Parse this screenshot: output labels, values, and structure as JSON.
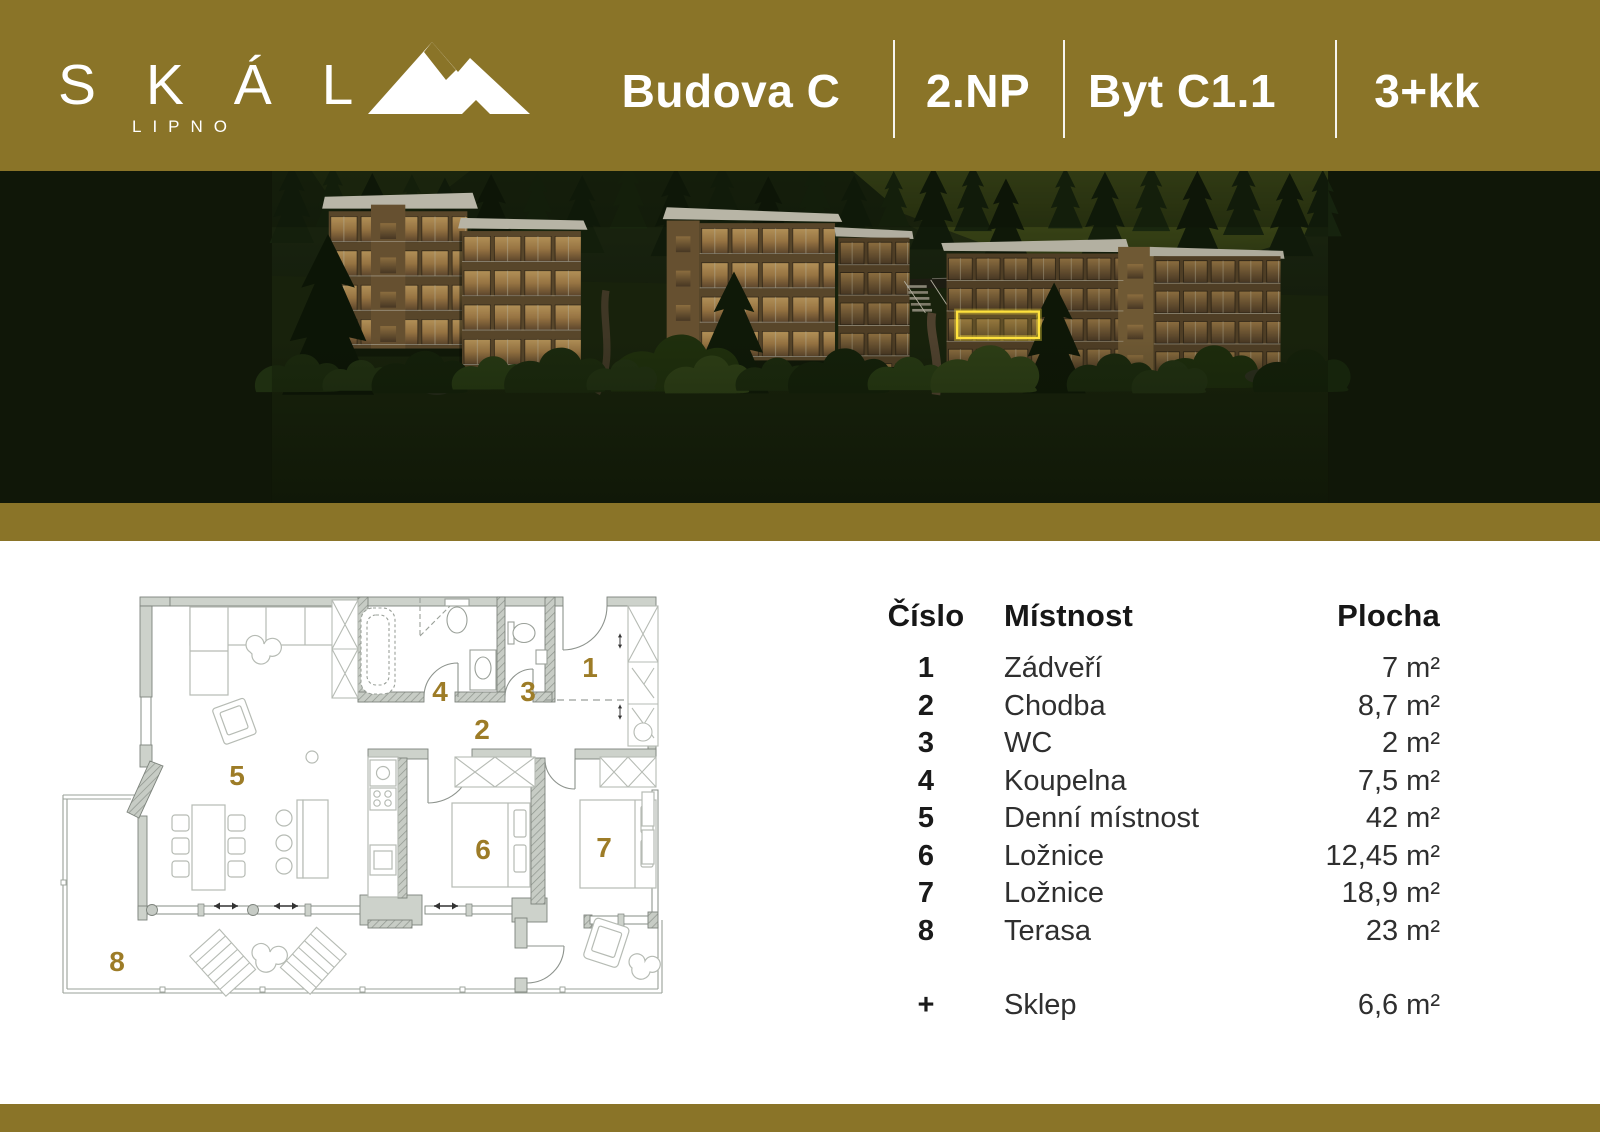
{
  "header": {
    "background_color": "#8a7428",
    "logo": {
      "text": "S K Á L",
      "subtext": "LIPNO",
      "icon": "mountain-icon"
    },
    "items": [
      "Budova C",
      "2.NP",
      "Byt C1.1",
      "3+kk"
    ]
  },
  "hero": {
    "highlight_color": "#ffe23d"
  },
  "floorplan": {
    "number_color": "#9d7c27",
    "room_numbers": [
      "1",
      "2",
      "3",
      "4",
      "5",
      "6",
      "7",
      "8"
    ]
  },
  "legend": {
    "headers": {
      "number": "Číslo",
      "room": "Místnost",
      "area": "Plocha"
    },
    "rows": [
      {
        "number": "1",
        "room": "Zádveří",
        "area": "7 m²"
      },
      {
        "number": "2",
        "room": "Chodba",
        "area": "8,7 m²"
      },
      {
        "number": "3",
        "room": "WC",
        "area": "2 m²"
      },
      {
        "number": "4",
        "room": "Koupelna",
        "area": "7,5 m²"
      },
      {
        "number": "5",
        "room": "Denní místnost",
        "area": "42 m²"
      },
      {
        "number": "6",
        "room": "Ložnice",
        "area": "12,45 m²"
      },
      {
        "number": "7",
        "room": "Ložnice",
        "area": "18,9 m²"
      },
      {
        "number": "8",
        "room": "Terasa",
        "area": "23 m²"
      }
    ],
    "extra_row": {
      "number": "+",
      "room": "Sklep",
      "area": "6,6 m²"
    }
  }
}
